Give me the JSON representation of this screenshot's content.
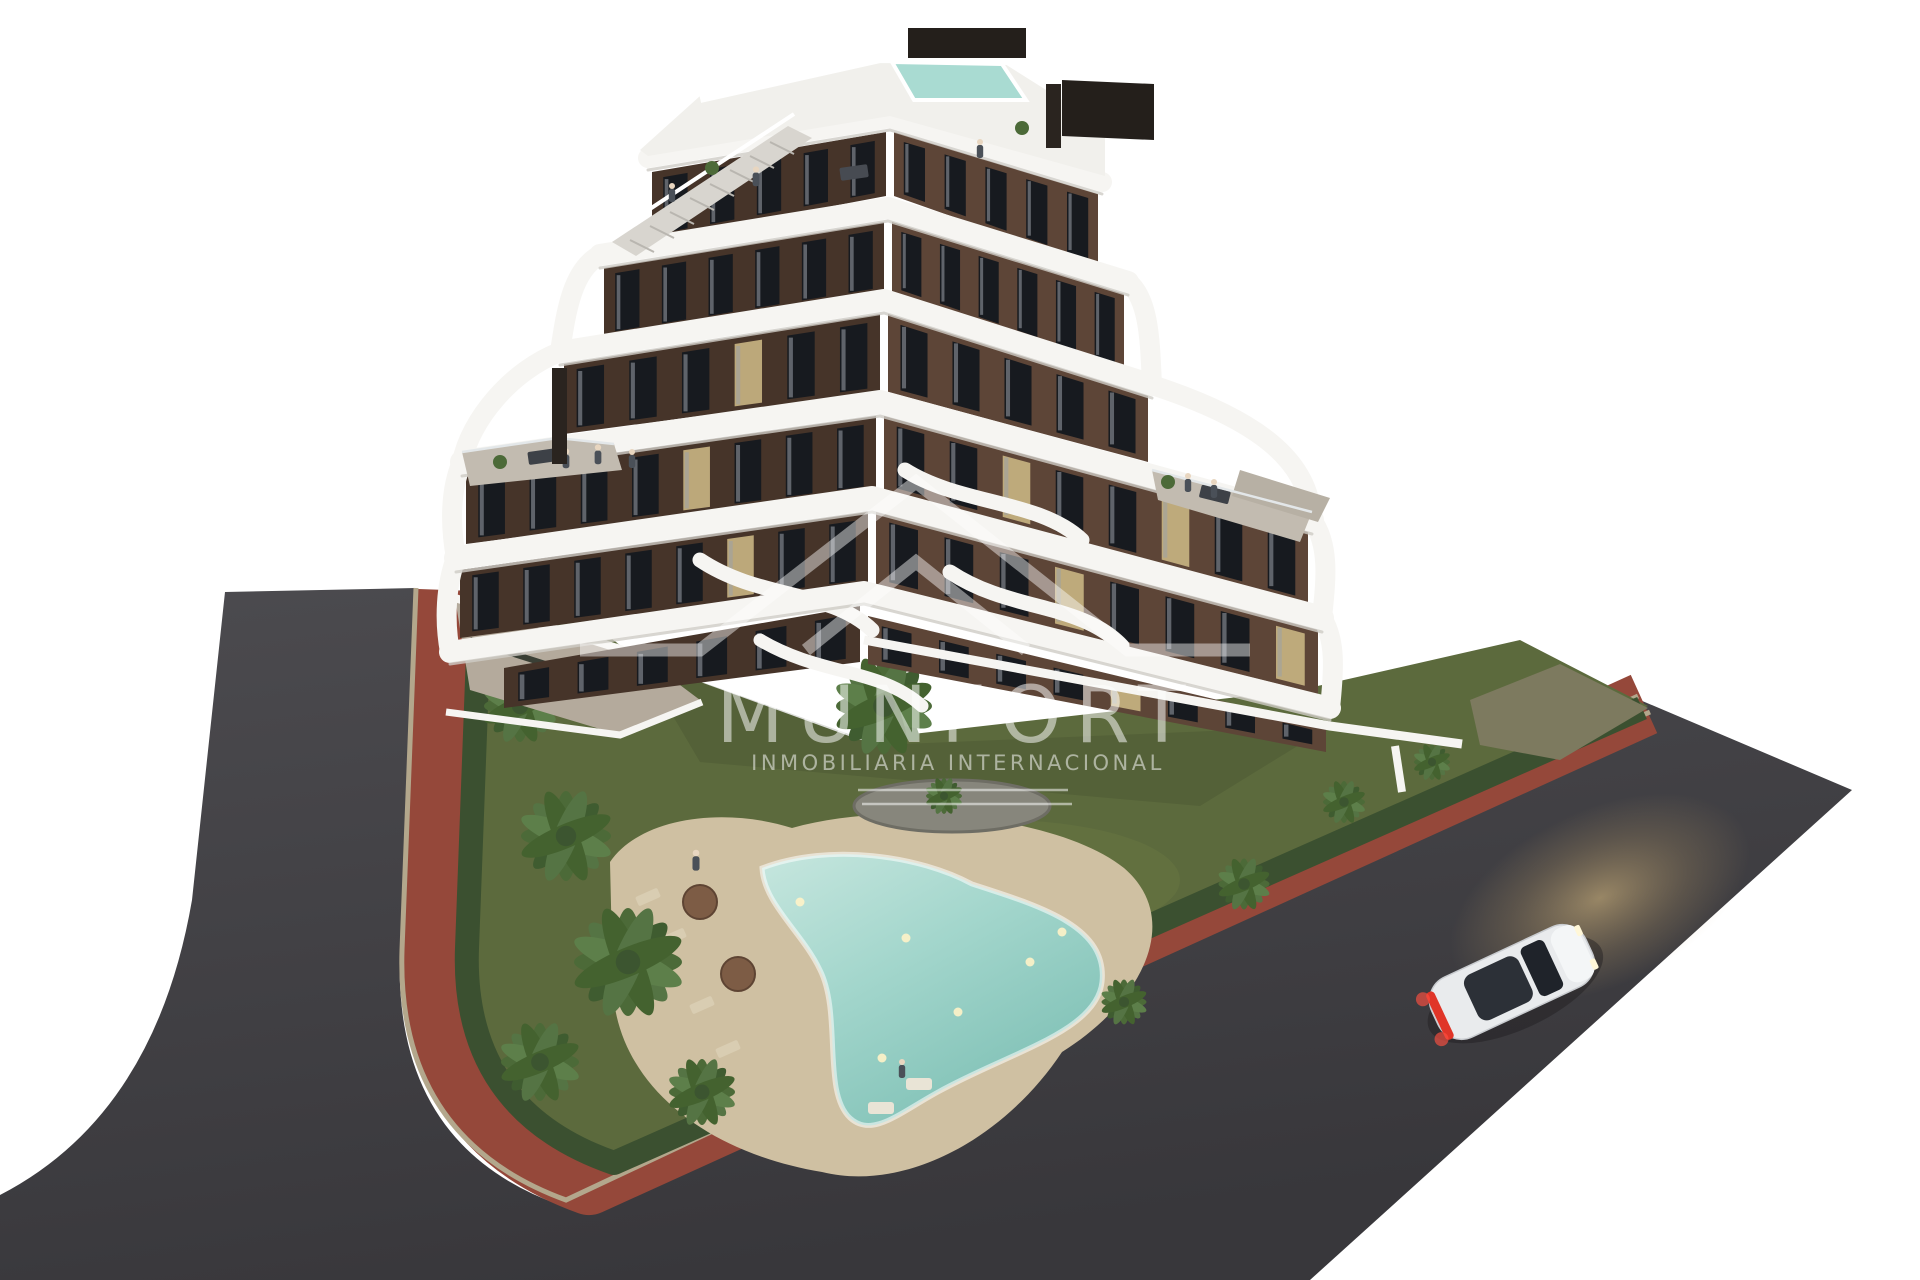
{
  "meta": {
    "type": "3d-architectural-render",
    "time_of_day": "dusk",
    "background": "#ffffff",
    "description": "Aerial view of a modern stepped apartment building with curved white balcony bands, landscaped garden with free-form pool, wrap-around road with terracotta bike lane, and a single white car."
  },
  "watermark": {
    "brand": "MUNFORT",
    "tagline": "INMOBILIARIA INTERNACIONAL",
    "logo": "double-roof-chevron-icon",
    "color": "#ffffff",
    "opacity": "0.52"
  },
  "palette": {
    "background": "#ffffff",
    "asphalt": "#414044",
    "asphalt_light": "#4c4b4f",
    "bike_path": "#95483a",
    "curb": "#b3a78c",
    "grass": "#5c6a3d",
    "grass_light": "#6d7a46",
    "hedge": "#3b5030",
    "sand_deck": "#cfc0a2",
    "pool_water": "#a3d6cc",
    "pool_deep": "#7dbfb4",
    "pool_light": "#fff3c8",
    "rooftop_pool": "#a9dbd2",
    "facade_left": "#463429",
    "facade_right": "#5d4537",
    "band_white": "#f6f5f2",
    "terrace_floor": "#c2bbb0",
    "window_dark": "#171a1f",
    "window_lit": "#c9b583",
    "stair": "#d8d5cf",
    "screen_dark": "#241f1b",
    "chimney": "#2a241f",
    "pebbles": "#87867c",
    "concrete": "#b4aa9c",
    "car_body": "#e9ebed",
    "car_glass": "#2c3037",
    "taillight": "#e03528",
    "headlight_glow": "#d9b878",
    "palm_frond": "#4c6a38",
    "palm_dark": "#3c5530",
    "umbrella": "#7d5c45",
    "lounger": "#d9cdb2"
  }
}
